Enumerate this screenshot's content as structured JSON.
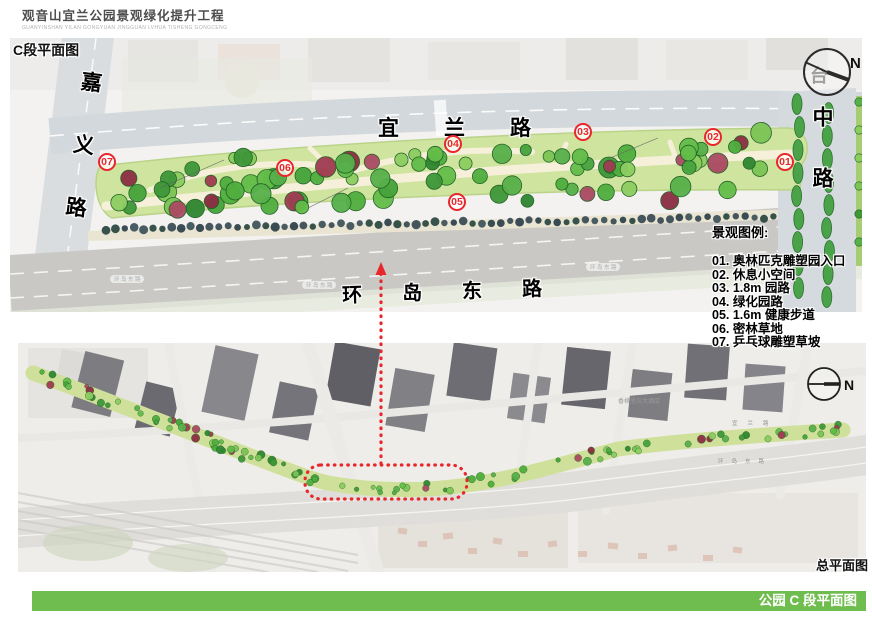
{
  "header": {
    "title": "观音山宜兰公园景观绿化提升工程",
    "subtitle": "GUANYINSHAN YILAN GONGYUAN JINGGUAN LVHUA TISHENG GONGCENG"
  },
  "plan": {
    "label": "C段平面图",
    "north_label": "N",
    "basemap_char": "台",
    "roads": {
      "jiayi": "嘉义路",
      "yilan": "宜兰路",
      "zhong": "中路",
      "huandao_east": "环岛东路"
    },
    "markers": [
      {
        "label": "01"
      },
      {
        "label": "02"
      },
      {
        "label": "03"
      },
      {
        "label": "04"
      },
      {
        "label": "05"
      },
      {
        "label": "06"
      },
      {
        "label": "07"
      }
    ]
  },
  "legend": {
    "title": "景观图例:",
    "items": [
      "01. 奥林匹克雕塑园入口",
      "02. 休息小空间",
      "03. 1.8m 园路",
      "04. 绿化园路",
      "05. 1.6m 健康步道",
      "06. 密林草地",
      "07. 乒乓球雕塑草坡"
    ]
  },
  "overview": {
    "label": "总平面图",
    "north_label": "N",
    "basemap_labels": {
      "hotel": "香格里拉大酒店",
      "yilan_road": "宜兰路",
      "huandao_east_road": "环岛东路"
    }
  },
  "footer": {
    "title": "公园 C 段平面图"
  },
  "colors": {
    "footer_green": "#6fbd4e",
    "marker_red": "#e8272d"
  }
}
